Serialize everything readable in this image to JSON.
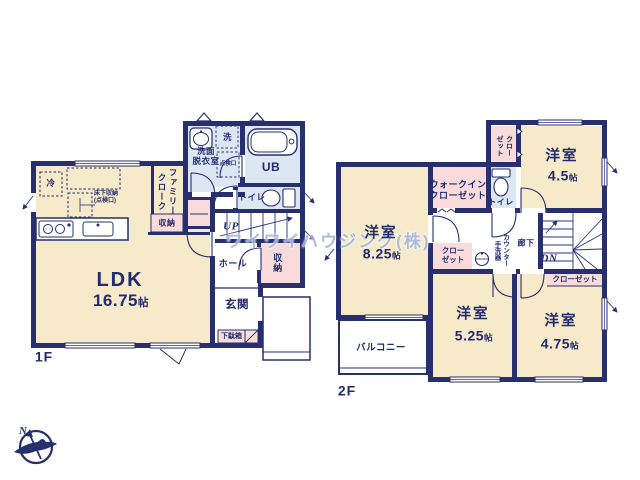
{
  "watermark": "ワイワイハウジング(株)",
  "compass": {
    "north": "N"
  },
  "floor1": {
    "floor_label": "1F",
    "ldk": {
      "name": "LDK",
      "size": "16.75",
      "unit": "帖"
    },
    "washroom": "洗面\n脱衣室",
    "laundry": "洗",
    "inspection_hatch": "点検口",
    "unit_bath": "UB",
    "toilet": "トイレ",
    "stairs_up": "UP",
    "hall": "ホール",
    "hall_storage": "収納",
    "entrance": "玄関",
    "shoe_cabinet": "下駄箱",
    "family_cloak": "ファミリー\nクローク",
    "cloak_storage": "収納",
    "fridge": "冷",
    "underfloor_storage": "床下収納\n(点検口)"
  },
  "floor2": {
    "floor_label": "2F",
    "room_4_5": {
      "name": "洋室",
      "size": "4.5",
      "unit": "帖"
    },
    "room_8_25": {
      "name": "洋室",
      "size": "8.25",
      "unit": "帖"
    },
    "room_5_25": {
      "name": "洋室",
      "size": "5.25",
      "unit": "帖"
    },
    "room_4_75": {
      "name": "洋室",
      "size": "4.75",
      "unit": "帖"
    },
    "closet_top": "クロー\nゼット",
    "closet_825": "クロー\nゼット",
    "closet_stairs": "クローゼット",
    "walk_in_closet": "ウォークイン\nクローゼット",
    "toilet": "トイレ",
    "counter_basin": "カウンター\n手洗器",
    "corridor": "廊下",
    "stairs_down": "DN",
    "balcony": "バルコニー"
  },
  "colors": {
    "wall_navy": "#272f6e",
    "room_cream": "#f6eacb",
    "wet_blue": "#dce7f3",
    "closet_pink": "#f8dbda",
    "watermark_blue": "#a6b7de"
  }
}
